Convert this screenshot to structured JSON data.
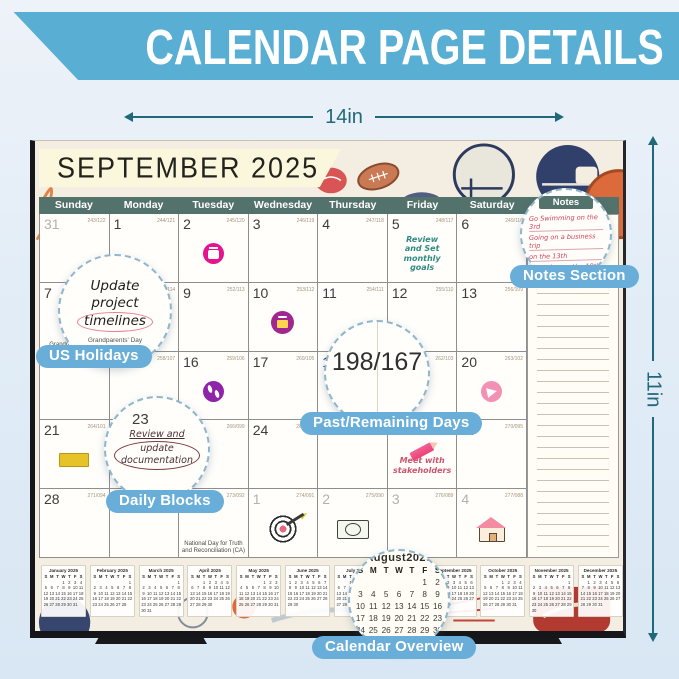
{
  "banner": {
    "title": "CALENDAR PAGE DETAILS"
  },
  "dimensions": {
    "width_label": "14in",
    "height_label": "11in"
  },
  "calendar": {
    "title": "SEPTEMBER 2025",
    "day_headers": [
      "Sunday",
      "Monday",
      "Tuesday",
      "Wednesday",
      "Thursday",
      "Friday",
      "Saturday"
    ],
    "notes_header": "Notes",
    "cells": [
      {
        "day": "31",
        "meta": "243/122",
        "muted": true
      },
      {
        "day": "1",
        "meta": "244/121",
        "holiday": "Labor Day"
      },
      {
        "day": "2",
        "meta": "245/120",
        "sticker": "calendar-pink"
      },
      {
        "day": "3",
        "meta": "246/119"
      },
      {
        "day": "4",
        "meta": "247/118"
      },
      {
        "day": "5",
        "meta": "248/117",
        "note": {
          "text": "Review\nand Set\nmonthly\ngoals",
          "color": "#2f8b80"
        }
      },
      {
        "day": "6",
        "meta": "249/116"
      },
      {
        "day": "7",
        "meta": "250/115",
        "holiday": "Grandparents' Day"
      },
      {
        "day": "8",
        "meta": "251/114"
      },
      {
        "day": "9",
        "meta": "252/113"
      },
      {
        "day": "10",
        "meta": "253/112",
        "sticker": "camera-purple"
      },
      {
        "day": "11",
        "meta": "254/111"
      },
      {
        "day": "12",
        "meta": "255/110"
      },
      {
        "day": "13",
        "meta": "256/109"
      },
      {
        "day": "14",
        "meta": "257/108"
      },
      {
        "day": "15",
        "meta": "258/107"
      },
      {
        "day": "16",
        "meta": "259/106",
        "sticker": "steps-purple"
      },
      {
        "day": "17",
        "meta": "260/105"
      },
      {
        "day": "18",
        "meta": "261/104"
      },
      {
        "day": "19",
        "meta": "262/103"
      },
      {
        "day": "20",
        "meta": "263/102",
        "sticker": "megaphone-pink"
      },
      {
        "day": "21",
        "meta": "264/101",
        "sticker": "highlight-yellow"
      },
      {
        "day": "22",
        "meta": "265/100"
      },
      {
        "day": "23",
        "meta": "266/099"
      },
      {
        "day": "24",
        "meta": "267/098"
      },
      {
        "day": "25",
        "meta": "268/097"
      },
      {
        "day": "26",
        "meta": "269/096",
        "sticker": "pencil-pink",
        "note": {
          "text": "Meet with\nstakeholders",
          "color": "#c9566e"
        }
      },
      {
        "day": "27",
        "meta": "270/095"
      },
      {
        "day": "28",
        "meta": "271/094"
      },
      {
        "day": "29",
        "meta": "272/093"
      },
      {
        "day": "30",
        "meta": "273/092",
        "holiday": "National Day for Truth\nand Reconciliation (CA)"
      },
      {
        "day": "1",
        "meta": "274/091",
        "muted": true,
        "sticker": "target"
      },
      {
        "day": "2",
        "meta": "275/090",
        "muted": true,
        "sticker": "money"
      },
      {
        "day": "3",
        "meta": "276/089",
        "muted": true
      },
      {
        "day": "4",
        "meta": "277/088",
        "muted": true,
        "sticker": "house"
      }
    ]
  },
  "callouts": {
    "us_holidays": "US Holidays",
    "notes_section": "Notes Section",
    "past_remaining": "Past/Remaining Days",
    "daily_blocks": "Daily Blocks",
    "calendar_overview": "Calendar Overview"
  },
  "bubbles": {
    "update_note": {
      "lines": [
        "Update",
        "project",
        "timelines"
      ],
      "holiday": "Grandparents' Day"
    },
    "past_remaining_value": "198/167",
    "review_note": {
      "day": "23",
      "line1": "Review and",
      "line2": "update\ndocumentation"
    },
    "notes": {
      "header": "Notes",
      "entries": [
        "Go Swimming on the 3rd",
        "Going on a business trip",
        "on the 13th",
        "Shopping on the 18th"
      ]
    },
    "august_month": {
      "name": "August2025",
      "first": 5,
      "days": 31
    }
  },
  "mini_dow": [
    "S",
    "M",
    "T",
    "W",
    "T",
    "F",
    "S"
  ],
  "mini_months": [
    {
      "name": "January 2025",
      "first": 3,
      "days": 31
    },
    {
      "name": "February 2025",
      "first": 6,
      "days": 28
    },
    {
      "name": "March 2025",
      "first": 6,
      "days": 31
    },
    {
      "name": "April 2025",
      "first": 2,
      "days": 30
    },
    {
      "name": "May 2025",
      "first": 4,
      "days": 31
    },
    {
      "name": "June 2025",
      "first": 0,
      "days": 30
    },
    {
      "name": "July 2025",
      "first": 2,
      "days": 31
    },
    {
      "name": "August 2025",
      "first": 5,
      "days": 31
    },
    {
      "name": "September 2025",
      "first": 1,
      "days": 30
    },
    {
      "name": "October 2025",
      "first": 3,
      "days": 31
    },
    {
      "name": "November 2025",
      "first": 6,
      "days": 30
    },
    {
      "name": "December 2025",
      "first": 1,
      "days": 31
    }
  ]
}
